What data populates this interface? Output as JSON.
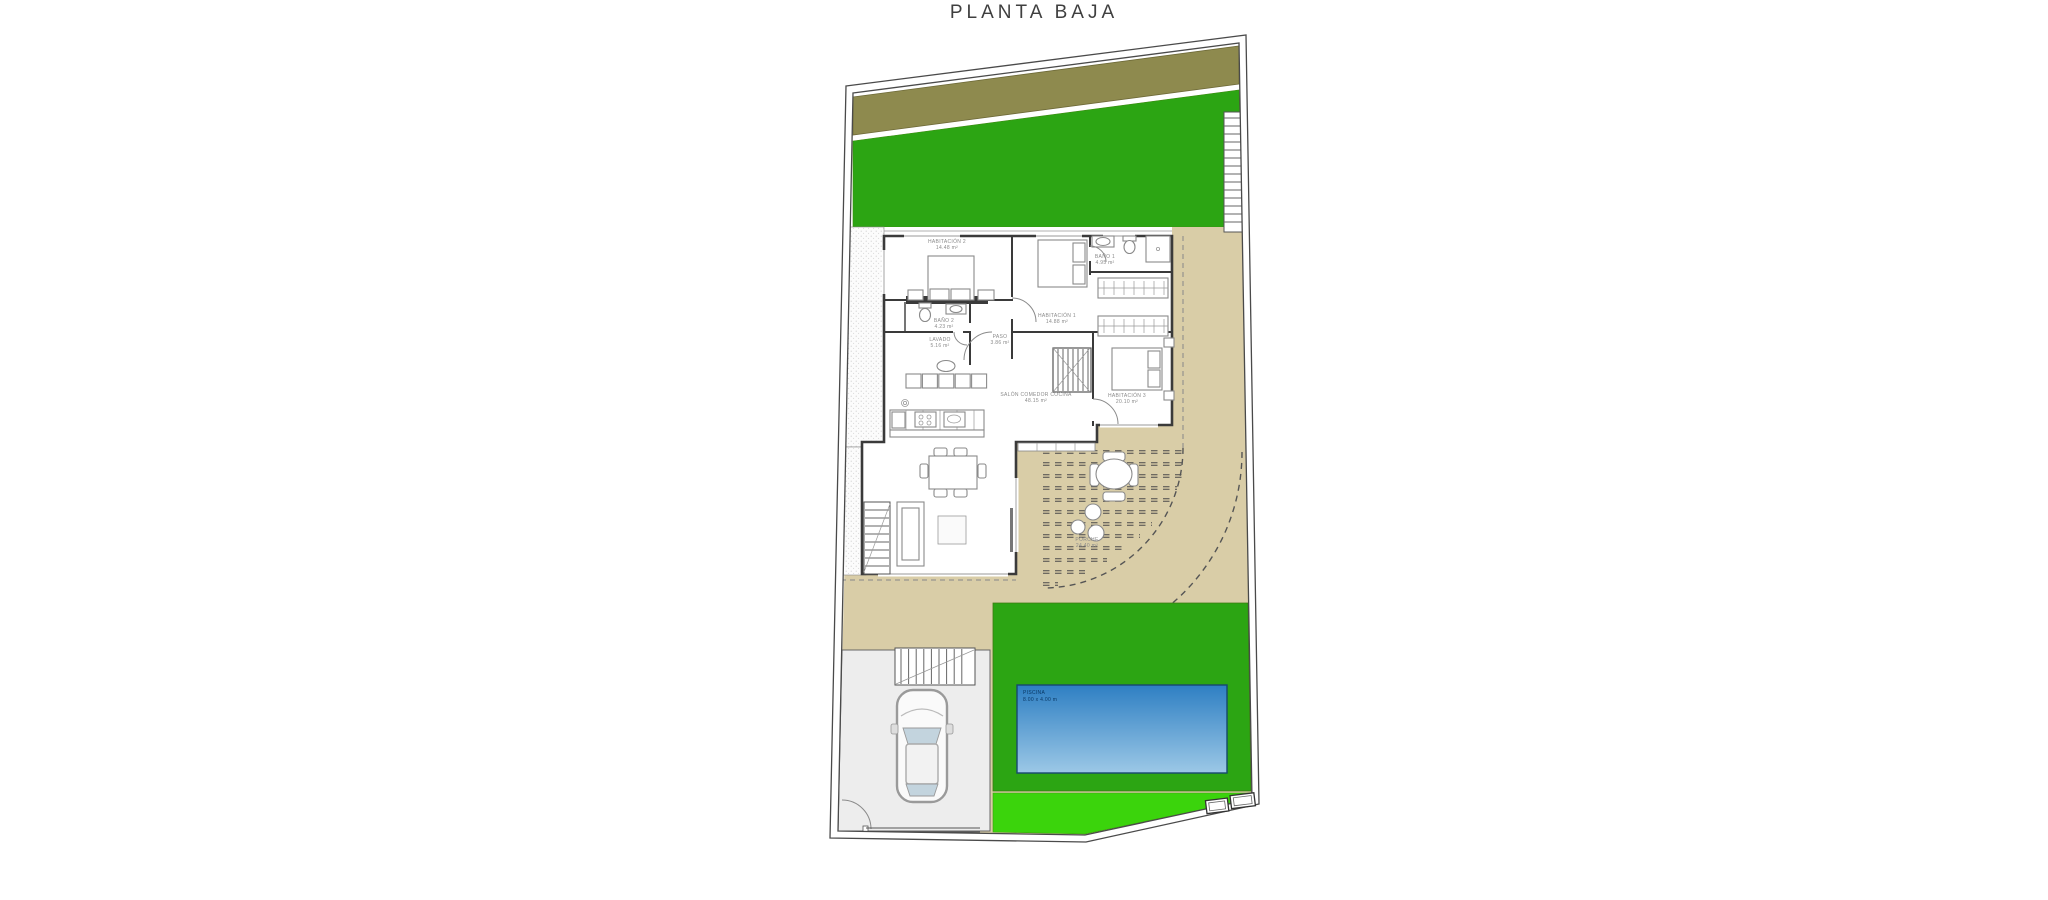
{
  "title": "PLANTA BAJA",
  "rooms": {
    "habitacion2": {
      "label": "HABITACIÓN 2",
      "area": "14.48 m²"
    },
    "habitacion1": {
      "label": "HABITACIÓN 1",
      "area": "14.88 m²"
    },
    "bano1": {
      "label": "BAÑO 1",
      "area": "4.95 m²"
    },
    "bano2": {
      "label": "BAÑO 2",
      "area": "4.23 m²"
    },
    "lavado": {
      "label": "LAVADO",
      "area": "5.16 m²"
    },
    "paso": {
      "label": "PASO",
      "area": "3.86 m²"
    },
    "habitacion3": {
      "label": "HABITACIÓN 3",
      "area": "20.10 m²"
    },
    "salon": {
      "label": "SALÓN COMEDOR COCINA",
      "area": "48.15 m²"
    },
    "porche": {
      "label": "PORCHE",
      "area": "24.40 m²"
    },
    "piscina": {
      "label": "PISCINA",
      "area": "8.00 x 4.00 m"
    }
  },
  "colors": {
    "olive_band": "#8E8A4E",
    "grass_green": "#2CA513",
    "lawn_bright_green": "#3BD40C",
    "terrain_tan": "#D9CDA7",
    "paving_gray": "#EDEDED",
    "pool_blue_top": "#2E7FC3",
    "pool_blue_bottom": "#9CC8E6",
    "wall_dark": "#3A3A3A"
  }
}
